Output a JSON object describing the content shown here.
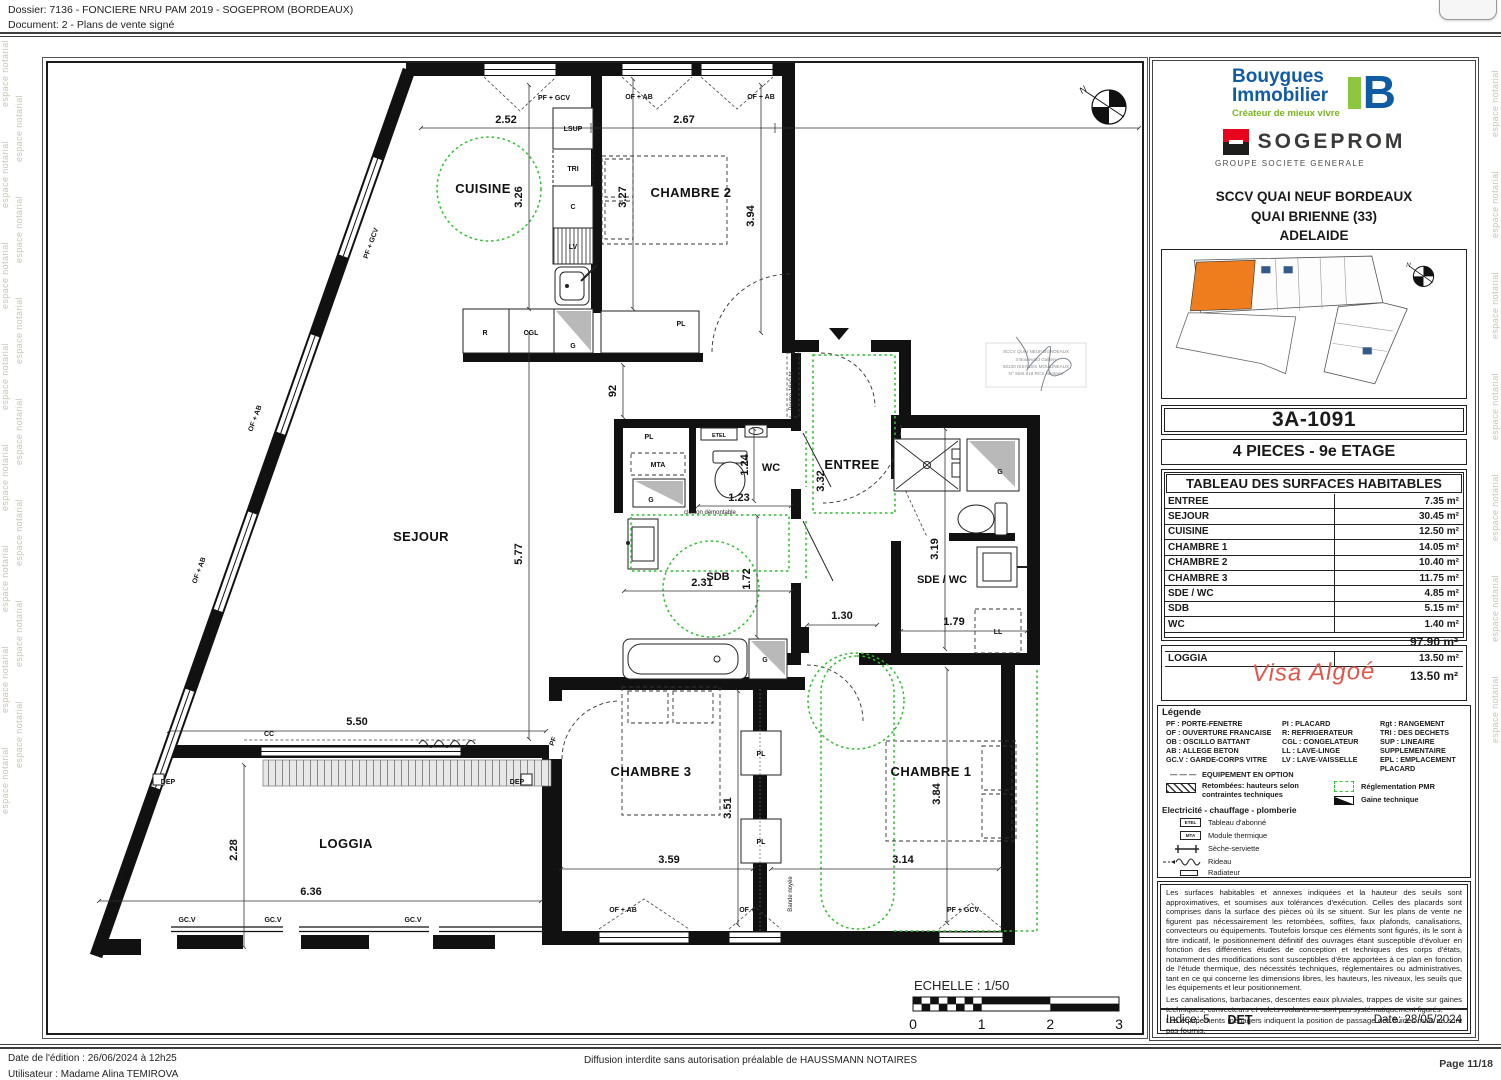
{
  "header": {
    "dossier": "Dossier: 7136 - FONCIERE NRU PAM 2019 - SOGEPROM (BORDEAUX)",
    "document": "Document: 2 - Plans de vente signé"
  },
  "watermark": {
    "text": "espace notarial"
  },
  "plan": {
    "rooms": {
      "cuisine": "CUISINE",
      "chambre2": "CHAMBRE 2",
      "sejour": "SEJOUR",
      "wc": "WC",
      "entree": "ENTREE",
      "sdb": "SDB",
      "sde_wc": "SDE / WC",
      "chambre3": "CHAMBRE 3",
      "chambre1": "CHAMBRE 1",
      "loggia": "LOGGIA"
    },
    "dims": {
      "v252": "2.52",
      "v267": "2.67",
      "v326": "3.26",
      "v327": "3.27",
      "v394": "3.94",
      "v577": "5.77",
      "v92": "92",
      "v124": "1.24",
      "v123": "1.23",
      "v332": "3.32",
      "v231": "2.31",
      "v172": "1.72",
      "v319": "3.19",
      "v130": "1.30",
      "v179": "1.79",
      "v550": "5.50",
      "v228": "2.28",
      "v636": "6.36",
      "v351": "3.51",
      "v359": "3.59",
      "v384": "3.84",
      "v314": "3.14"
    },
    "labels": {
      "pf_gcv": "PF + GCV",
      "of_ab": "OF + AB",
      "pf": "PF",
      "lsup": "LSUP",
      "tri": "TRI",
      "c": "C",
      "lv": "LV",
      "r": "R",
      "cgl": "CGL",
      "g": "G",
      "pl": "PL",
      "etel": "ETEL",
      "mta": "MTA",
      "ll": "LL",
      "cc": "CC",
      "dep": "DEP",
      "gcv": "GC.V",
      "cloison": "cloison démontable",
      "poutre": "Poutre 16x0 ht",
      "bande": "Bande noyée",
      "north": "N"
    },
    "scale": {
      "label": "ECHELLE : 1/50",
      "ticks": [
        "0",
        "1",
        "2",
        "3"
      ]
    },
    "stamp": {
      "l1": "SCCV QUAI NEUF BORDEAUX",
      "l2": "3 Boulevard Gallieni",
      "l3": "92130 ISSY LES MOULINEAUX",
      "l4": "N° Siret 818 RCS Nanterre"
    }
  },
  "panel": {
    "bouygues": {
      "line1": "Bouygues",
      "line2": "Immobilier",
      "tagline": "Créateur de mieux vivre",
      "mark": "B"
    },
    "sogeprom": {
      "name": "SOGEPROM",
      "group": "GROUPE SOCIETE GENERALE"
    },
    "project": {
      "line1": "SCCV QUAI NEUF BORDEAUX",
      "line2": "QUAI BRIENNE (33)",
      "line3": "ADELAIDE"
    },
    "lot_code": "3A-1091",
    "lot_type": "4 PIECES  -  9e ETAGE",
    "surface_table": {
      "title": "TABLEAU DES SURFACES HABITABLES",
      "rows": [
        {
          "label": "ENTREE",
          "value": "7.35 m²"
        },
        {
          "label": "SEJOUR",
          "value": "30.45 m²"
        },
        {
          "label": "CUISINE",
          "value": "12.50 m²"
        },
        {
          "label": "CHAMBRE 1",
          "value": "14.05 m²"
        },
        {
          "label": "CHAMBRE 2",
          "value": "10.40 m²"
        },
        {
          "label": "CHAMBRE 3",
          "value": "11.75 m²"
        },
        {
          "label": "SDE / WC",
          "value": "4.85 m²"
        },
        {
          "label": "SDB",
          "value": "5.15 m²"
        },
        {
          "label": "WC",
          "value": "1.40 m²"
        }
      ],
      "total": "97.90 m²",
      "annex_row": {
        "label": "LOGGIA",
        "value": "13.50 m²"
      },
      "annex_total": "13.50 m²"
    },
    "visa": "Visa Algoé",
    "legend": {
      "title": "Légende",
      "col1": [
        "PF : PORTE-FENETRE",
        "OF : OUVERTURE FRANCAISE",
        "OB : OSCILLO BATTANT",
        "AB : ALLEGE BETON",
        "GC.V : GARDE-CORPS VITRE"
      ],
      "col2": [
        "PI : PLACARD",
        "R: REFRIGERATEUR",
        "CGL : CONGELATEUR",
        "LL : LAVE-LINGE",
        "LV : LAVE-VAISSELLE"
      ],
      "col3": [
        "Rgt : RANGEMENT",
        "TRI : DES DECHETS",
        "SUP : LINEAIRE",
        "SUPPLEMENTAIRE",
        "EPL : EMPLACEMENT",
        "PLACARD"
      ],
      "option": "EQUIPEMENT EN OPTION",
      "option_dash": "— — —",
      "retombees1": "Retombées: hauteurs selon",
      "retombees2": "contraintes techniques",
      "pmr": "Réglementation PMR",
      "gaine": "Gaine technique",
      "elec": "Electricité - chauffage - plomberie",
      "etel_icon": "ETEL",
      "etel": "Tableau d'abonné",
      "mta_icon": "MTA",
      "mta": "Module thermique",
      "seche": "Sèche-serviette",
      "rideau": "Rideau",
      "radiateur": "Radiateur"
    },
    "legal": {
      "p1": "Les surfaces habitables et annexes indiquées et la hauteur des seuils sont approximatives, et soumises aux tolérances d'exécution. Celles des placards sont comprises dans la surface des pièces où ils se situent. Sur les plans de vente ne figurent pas nécessairement les retombées, soffites, faux plafonds, canalisations, convecteurs ou équipements. Toutefois lorsque ces éléments sont figurés, ils le sont à titre indicatif, le positionnement définitif des ouvrages étant susceptible d'évoluer en fonction des différentes études de conception et techniques des corps d'états, notamment des modifications sont susceptibles d'être apportées à ce plan en fonction de l'étude thermique, des nécessités techniques, réglementaires ou administratives, tant en ce qui concerne les dimensions libres, les hauteurs, les niveaux, les seuils que les équipements et leur positionnement.",
      "p2": "Les canalisations, barbacanes, descentes eaux pluviales, trappes de visite sur gaines techniques, convecteurs et volets roulants ne sont pas systématiquement figurés.",
      "p3": "Les équipements ménagers indiquent la position de passage des fluides mais ne sont pas fournis."
    },
    "indice": "Indice: 5",
    "det": "DET",
    "date": "Date: 28/05/2024"
  },
  "footer": {
    "edition": "Date de l'édition : 26/06/2024 à 12h25",
    "user": "Utilisateur : Madame Alina TEMIROVA",
    "diffusion": "Diffusion interdite sans autorisation préalable de HAUSSMANN NOTAIRES",
    "page": "Page 11/18"
  },
  "colors": {
    "accent_green": "#2fbf2f",
    "unit_orange": "#ef7d1d",
    "bouygues_blue": "#0f5ba4",
    "bouygues_green": "#8dc63f",
    "sogeprom_red": "#e9041e",
    "visa_red": "#e2574d",
    "watermark": "#ccc4b4"
  }
}
